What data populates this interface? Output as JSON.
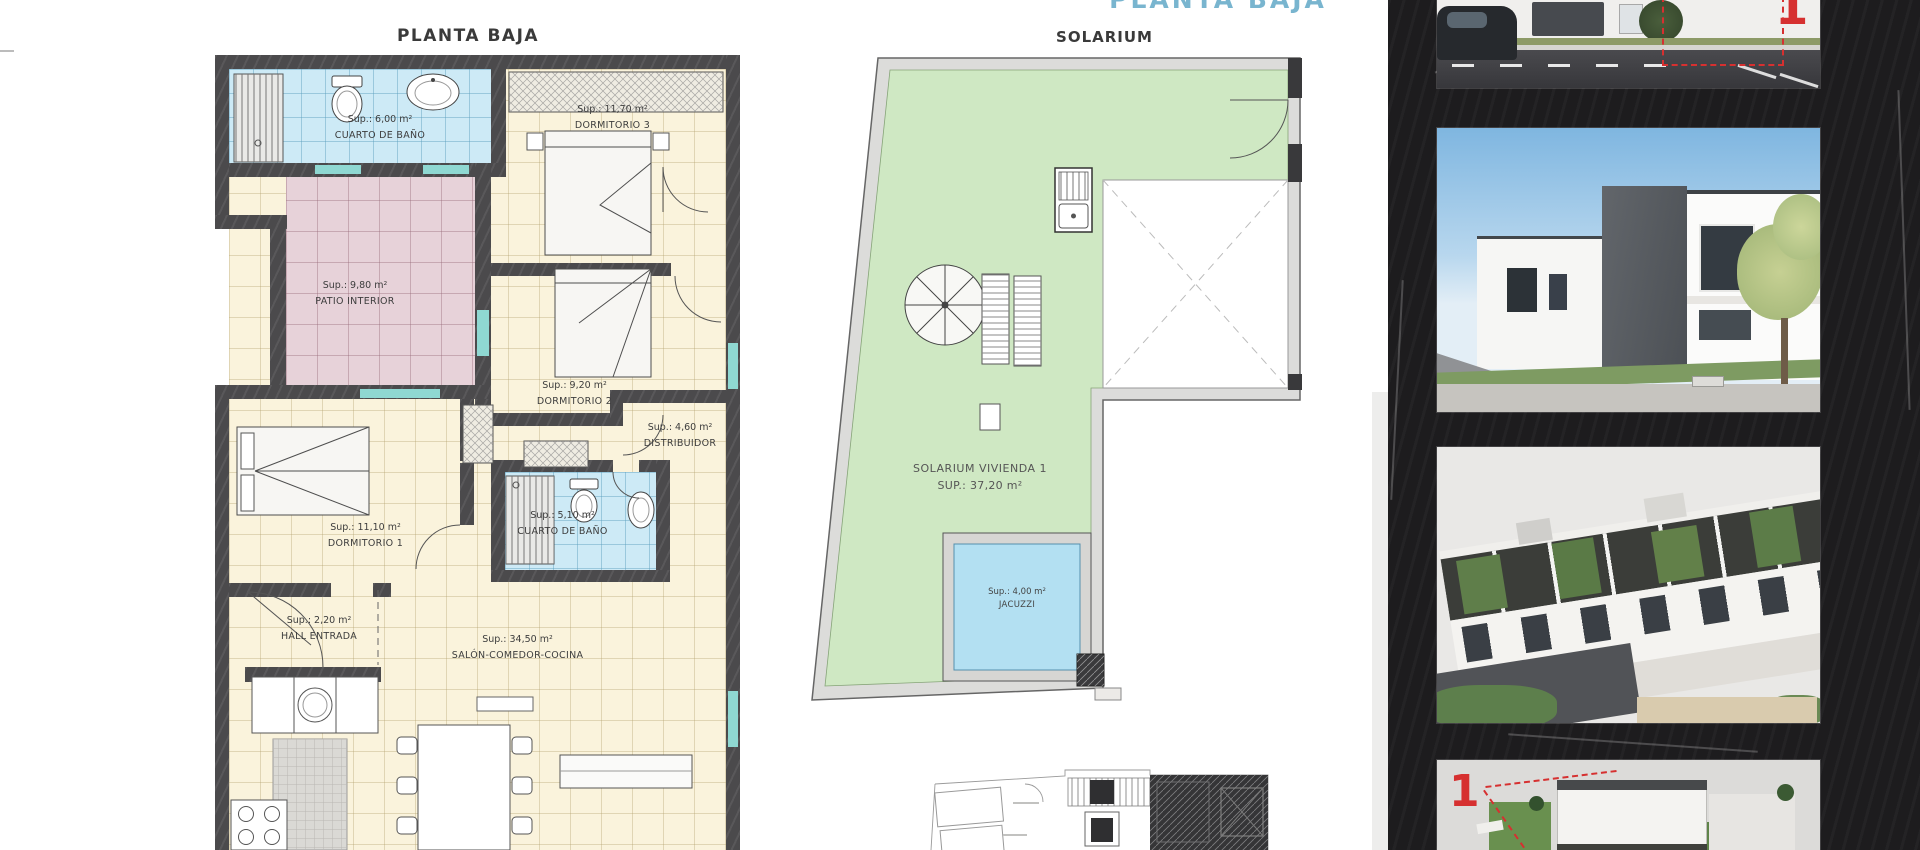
{
  "page": {
    "top_partial_title": "PLANTA BAJA"
  },
  "colors": {
    "accent_blue": "#79b5cf",
    "unit_red": "#d63030",
    "wall_dark": "#4b4a4c",
    "bath_blue": "#cdeaf6",
    "patio_pink": "#e7d2d9",
    "room_cream": "#faf3dc",
    "solarium_green": "#cfe8c3",
    "jacuzzi_blue": "#b3e0f2",
    "sidebar_dark": "#1d1c1e"
  },
  "planta_baja": {
    "title": "PLANTA BAJA",
    "rooms": {
      "bano_superior": {
        "area": "Sup.: 6,00 m²",
        "name": "CUARTO DE BAÑO"
      },
      "dormitorio3": {
        "area": "Sup.: 11,70 m²",
        "name": "DORMITORIO 3"
      },
      "patio": {
        "area": "Sup.: 9,80 m²",
        "name": "PATIO INTERIOR"
      },
      "dormitorio2": {
        "area": "Sup.: 9,20 m²",
        "name": "DORMITORIO 2"
      },
      "distribuidor": {
        "area": "Sup.: 4,60 m²",
        "name": "DISTRIBUIDOR"
      },
      "dormitorio1": {
        "area": "Sup.: 11,10 m²",
        "name": "DORMITORIO 1"
      },
      "bano_inferior": {
        "area": "Sup.: 5,10 m²",
        "name": "CUARTO DE BAÑO"
      },
      "hall": {
        "area": "Sup.: 2,20 m²",
        "name": "HALL ENTRADA"
      },
      "salon": {
        "area": "Sup.: 34,50 m²",
        "name": "SALÓN-COMEDOR-COCINA"
      }
    }
  },
  "solarium": {
    "title": "SOLARIUM",
    "vivienda_label": "SOLARIUM VIVIENDA 1",
    "vivienda_area": "SUP.: 37,20 m²",
    "jacuzzi": {
      "area": "Sup.: 4,00 m²",
      "name": "JACUZZI"
    }
  },
  "sidebar": {
    "photos": [
      {
        "name": "street-facade-render",
        "unit_badge": "1"
      },
      {
        "name": "building-exterior-render"
      },
      {
        "name": "rooftop-aerial-render"
      },
      {
        "name": "site-aerial-render",
        "unit_badge": "1"
      }
    ]
  }
}
